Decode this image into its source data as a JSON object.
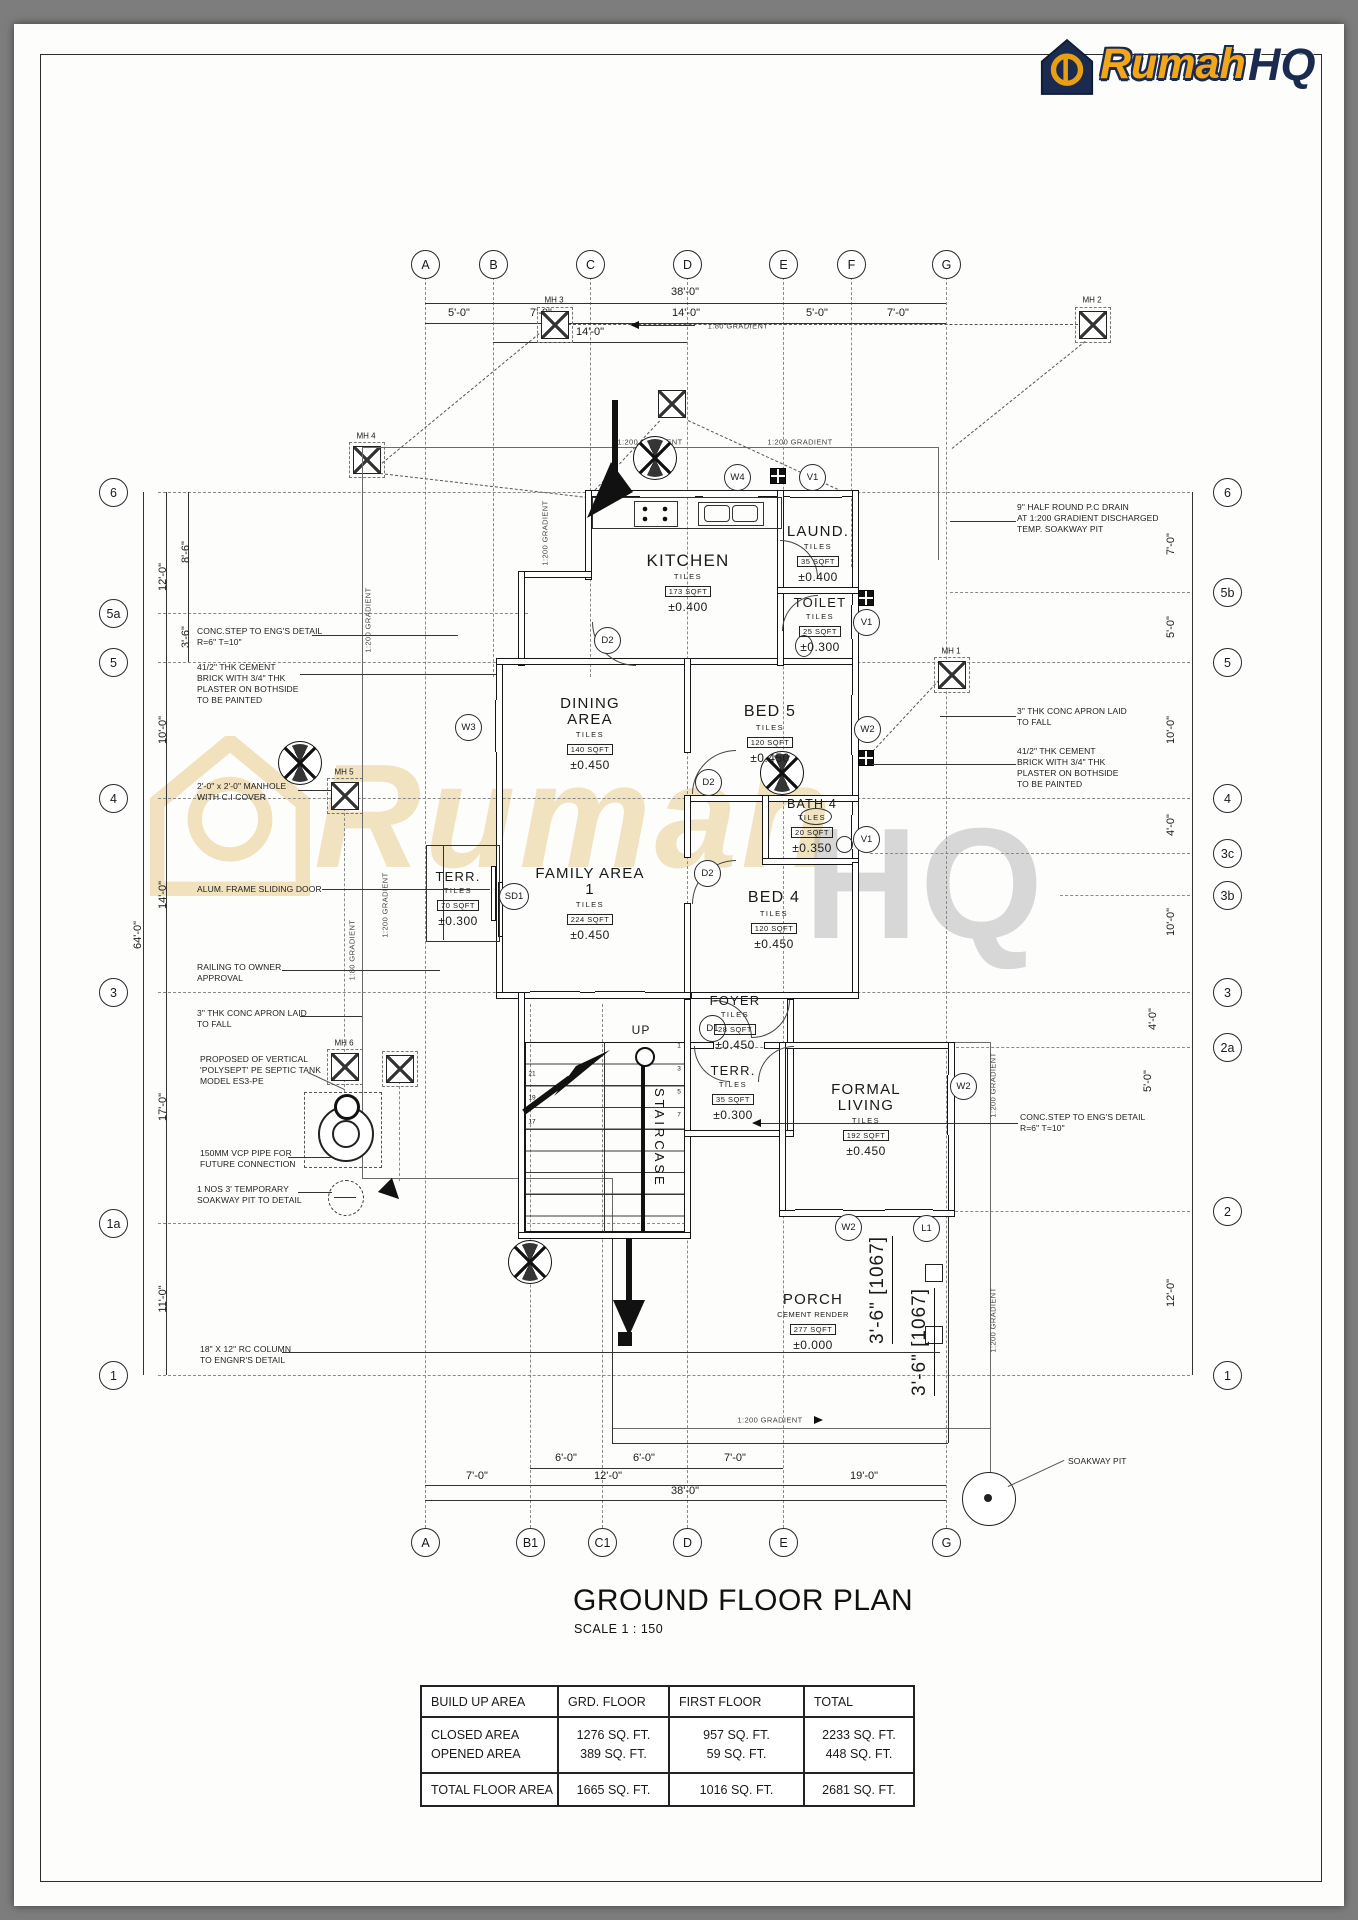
{
  "logo": {
    "rumah": "Rumah",
    "hq": "HQ"
  },
  "watermark": {
    "rumah": "Rumah",
    "hq": "HQ"
  },
  "title_block": {
    "title": "GROUND FLOOR PLAN",
    "scale": "SCALE 1 : 150"
  },
  "summary_table": {
    "headers": [
      "BUILD UP AREA",
      "GRD. FLOOR",
      "FIRST FLOOR",
      "TOTAL"
    ],
    "rows": [
      {
        "label": "CLOSED AREA",
        "grd": "1276 SQ. FT.",
        "first": "957 SQ. FT.",
        "total": "2233 SQ. FT."
      },
      {
        "label": "OPENED AREA",
        "grd": "389 SQ. FT.",
        "first": "59 SQ. FT.",
        "total": "448 SQ. FT."
      },
      {
        "label": "TOTAL FLOOR AREA",
        "grd": "1665 SQ. FT.",
        "first": "1016 SQ. FT.",
        "total": "2681 SQ. FT."
      }
    ]
  },
  "grid": {
    "top": [
      "A",
      "B",
      "C",
      "D",
      "E",
      "F",
      "G"
    ],
    "bottom": [
      "A",
      "B1",
      "C1",
      "D",
      "E",
      "G"
    ],
    "left": [
      "6",
      "5a",
      "5",
      "4",
      "3",
      "1a",
      "1"
    ],
    "right": [
      "6",
      "5b",
      "5",
      "4",
      "3c",
      "3b",
      "3",
      "2a",
      "2",
      "1"
    ]
  },
  "dims": {
    "top": {
      "overall": "38'-0\"",
      "segs": [
        "5'-0\"",
        "7'-0\"",
        "14'-0\"",
        "5'-0\"",
        "7'-0\""
      ],
      "sub": "14'-0\""
    },
    "bottom": {
      "segs1": [
        "6'-0\"",
        "6'-0\"",
        "7'-0\""
      ],
      "segs2": [
        "7'-0\"",
        "12'-0\"",
        "19'-0\""
      ],
      "overall": "38'-0\""
    },
    "left": {
      "overall": "64'-0\"",
      "segs": [
        "12'-0\"",
        "10'-0\"",
        "14'-0\"",
        "17'-0\"",
        "11'-0\""
      ],
      "subs": [
        "8'-6\"",
        "3'-6\""
      ]
    },
    "right": {
      "segs": [
        "7'-0\"",
        "5'-0\"",
        "10'-0\"",
        "4'-0\"",
        "10'-0\"",
        "4'-0\"",
        "5'-0\"",
        "12'-0\""
      ]
    },
    "porch": [
      "3'-6\" [1067]",
      "3'-6\" [1067]"
    ]
  },
  "rooms": [
    {
      "name": "KITCHEN",
      "finish": "TILES",
      "area": "173 SQFT",
      "level": "±0.400"
    },
    {
      "name": "LAUND.",
      "finish": "TILES",
      "area": "35 SQFT",
      "level": "±0.400"
    },
    {
      "name": "TOILET",
      "finish": "TILES",
      "area": "25 SQFT",
      "level": "±0.300"
    },
    {
      "name": "DINING AREA",
      "finish": "TILES",
      "area": "140 SQFT",
      "level": "±0.450"
    },
    {
      "name": "BED 5",
      "finish": "TILES",
      "area": "120 SQFT",
      "level": "±0.450"
    },
    {
      "name": "BATH 4",
      "finish": "TILES",
      "area": "20 SQFT",
      "level": "±0.350"
    },
    {
      "name": "TERR.",
      "finish": "TILES",
      "area": "70 SQFT",
      "level": "±0.300"
    },
    {
      "name": "FAMILY AREA 1",
      "finish": "TILES",
      "area": "224 SQFT",
      "level": "±0.450"
    },
    {
      "name": "BED 4",
      "finish": "TILES",
      "area": "120 SQFT",
      "level": "±0.450"
    },
    {
      "name": "FOYER",
      "finish": "TILES",
      "area": "28 SQFT",
      "level": "±0.450"
    },
    {
      "name": "TERR.",
      "finish": "TILES",
      "area": "35 SQFT",
      "level": "±0.300"
    },
    {
      "name": "FORMAL LIVING",
      "finish": "TILES",
      "area": "192 SQFT",
      "level": "±0.450"
    },
    {
      "name": "PORCH",
      "finish": "CEMENT RENDER",
      "area": "277 SQFT",
      "level": "±0.000"
    }
  ],
  "stair": {
    "up": "UP",
    "name": "STAIRCASE",
    "left_nums": [
      "21",
      "19",
      "17"
    ],
    "right_nums": [
      "1",
      "3",
      "5",
      "7"
    ]
  },
  "tags": {
    "w4": "W4",
    "v1": "V1",
    "d2": "D2",
    "d1": "D1",
    "w2": "W2",
    "w3": "W3",
    "sd1": "SD1",
    "l1": "L1"
  },
  "mh": {
    "mh1": "MH 1",
    "mh2": "MH 2",
    "mh3": "MH 3",
    "mh4": "MH 4",
    "mh5": "MH 5",
    "mh6": "MH 6"
  },
  "grad": {
    "g200": "1:200 GRADIENT",
    "g80": "1:80 GRADIENT"
  },
  "misc": {
    "soakway": "SOAKWAY PIT"
  },
  "ann": {
    "left": [
      "CONC.STEP TO ENG'S DETAIL\nR=6\" T=10\"",
      "41/2\" THK CEMENT\nBRICK WITH 3/4\" THK\nPLASTER ON BOTHSIDE\nTO BE PAINTED",
      "2'-0\" x 2'-0\" MANHOLE\nWITH C.I COVER",
      "ALUM. FRAME SLIDING DOOR",
      "RAILING TO OWNER\nAPPROVAL",
      "3\" THK CONC APRON LAID\nTO FALL",
      "PROPOSED OF VERTICAL\n'POLYSEPT' PE SEPTIC TANK\nMODEL ES3-PE",
      "150MM VCP PIPE FOR\nFUTURE CONNECTION",
      "1 NOS 3' TEMPORARY\nSOAKWAY PIT TO DETAIL",
      "18\" X 12\" RC COLUMN\nTO ENGNR'S DETAIL"
    ],
    "right": [
      "9\" HALF ROUND P.C DRAIN\nAT 1:200 GRADIENT DISCHARGED\nTEMP. SOAKWAY PIT",
      "3\" THK CONC APRON LAID\nTO FALL",
      "41/2\" THK CEMENT\nBRICK WITH 3/4\" THK\nPLASTER ON BOTHSIDE\nTO BE PAINTED",
      "CONC.STEP TO ENG'S DETAIL\nR=6\" T=10\"",
      "SOAKWAY PIT"
    ]
  }
}
